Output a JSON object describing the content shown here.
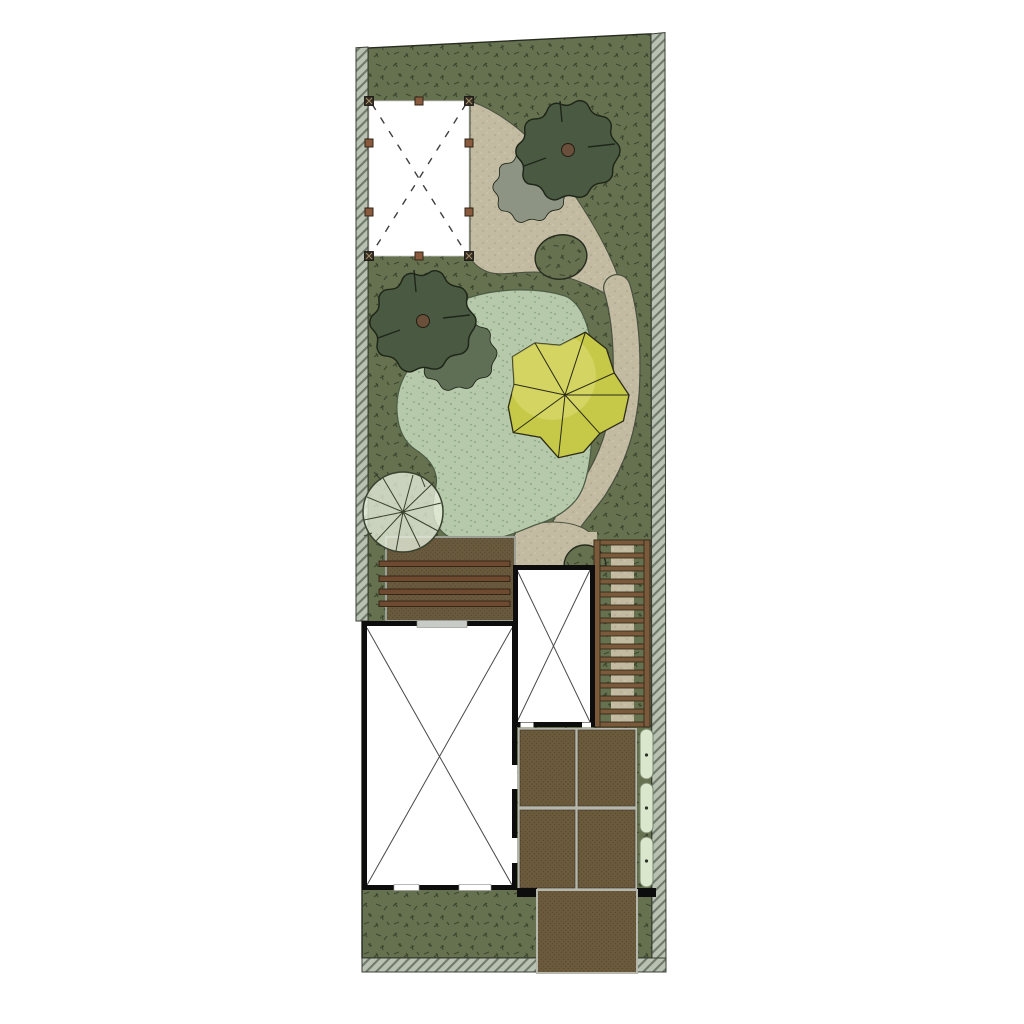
{
  "meta": {
    "canvas_width": 1024,
    "canvas_height": 1024,
    "description": "Top-down landscape architecture plan of a long narrow garden plot with house footprint, deck, pergola, paths, trees and patio"
  },
  "palette": {
    "page_bg": "#ffffff",
    "grass": "#66724f",
    "grass_mark": "#3d4730",
    "grass_outline": "#272c20",
    "lawn": "#b6c9aa",
    "lawn_dot": "#7e9e78",
    "lawn_outline": "#4e5e46",
    "path": "#c3bba1",
    "path_dot": "#a79f86",
    "path_light": "#d4cdb6",
    "path_edge": "#4a5140",
    "border_hatch_bg": "#b9c1b3",
    "border_hatch_line": "#6f7a6c",
    "border_outline": "#3a3f33",
    "tree_dark": "#4a5a42",
    "tree_dark_outline": "#1f2619",
    "tree_lobe_gray": "#8d9484",
    "tree_lobe_green": "#5f6f55",
    "trunk": "#6a4f3a",
    "tree_yellow": "#c6c847",
    "tree_yellow_light": "#dfe07c",
    "tree_yellow_outline": "#2b2b18",
    "pale_tree": "#e7eedd",
    "pale_tree_line": "#39412f",
    "deck": "#695a3e",
    "deck_dot": "#50432c",
    "deck_edge": "#9aa096",
    "deck_bar": "#6e4a31",
    "deck_bar_outline": "#2a1c12",
    "wall": "#0d0d0d",
    "room_fill": "#ffffff",
    "room_x": "#4a4a4a",
    "window_gray": "#c9ccc6",
    "window_frame": "#8a8d86",
    "stair_wood": "#7a5a3b",
    "stair_wood_outline": "#2e2317",
    "patio": "#6b5a3c",
    "patio_dot": "#4f4229",
    "patio_grout": "#b5b7ad",
    "pill": "#dbe7cd",
    "pill_outline": "#79856d",
    "pill_dot": "#2f3327",
    "pavilion_white": "#ffffff",
    "pavilion_dash": "#3f3f3f",
    "post_dark": "#342c20",
    "post_brown": "#8a5a3f",
    "post_outline": "#2f2416",
    "post_x": "#a3906c"
  },
  "scene": {
    "boundary": {
      "label": "plot boundary with hatched fence strips on left, right and bottom edges"
    },
    "pavilion": {
      "label": "pergola / canopy with dashed roof diagonals",
      "posts": 10
    },
    "path": {
      "label": "curved gravel path with oval planting island"
    },
    "lawn_area": {
      "label": "organic groundcover / planting bed"
    },
    "trees": {
      "dark_green": 2,
      "yellow": 1,
      "light_transparent": 1
    },
    "deck": {
      "label": "wooden deck with step planks",
      "steps": 4
    },
    "stairs": {
      "label": "timber-edged garden steps along right side",
      "treads": 14
    },
    "house": {
      "label": "building footprint, rooms marked with X",
      "rooms": 2
    },
    "patio": {
      "label": "large-format paved patio",
      "tiles": 4
    },
    "driveway": {
      "label": "paved walk extending through bottom boundary"
    },
    "stepping_stones": {
      "count": 3
    }
  }
}
